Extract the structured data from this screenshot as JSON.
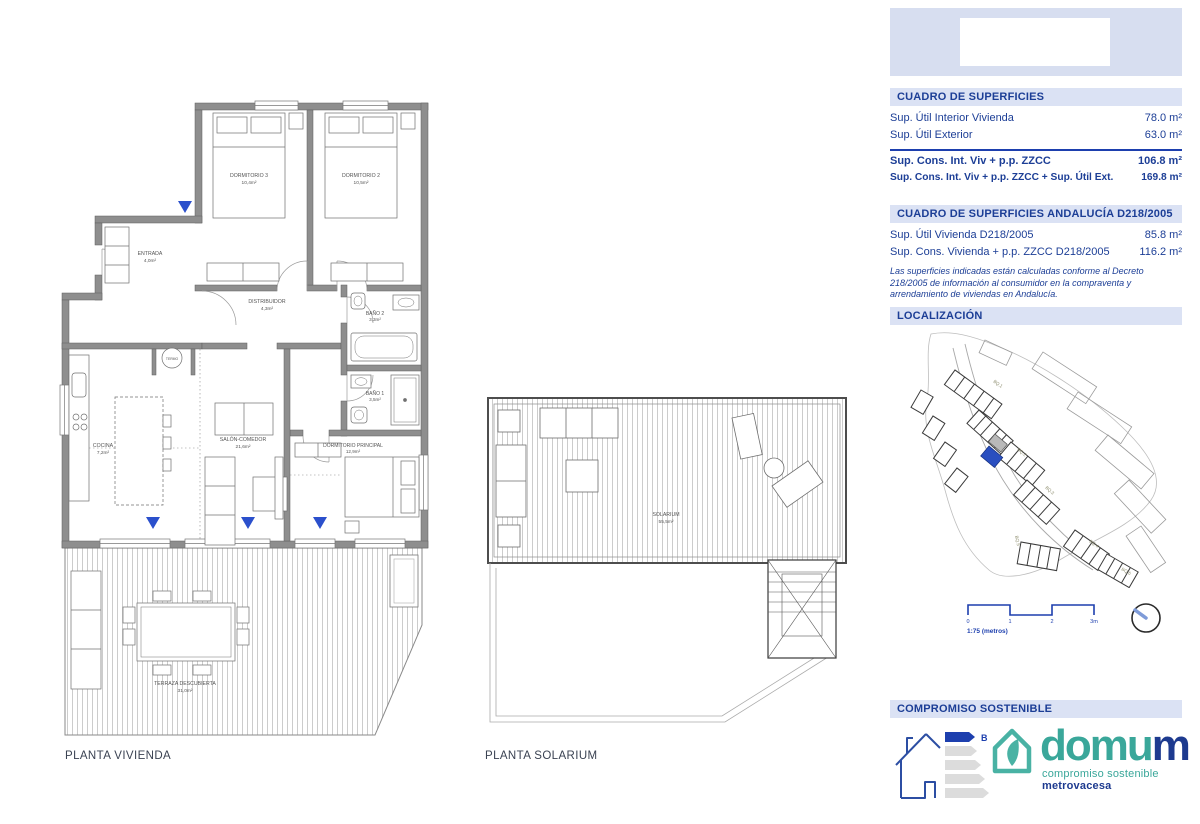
{
  "captions": {
    "vivienda": "PLANTA VIVIENDA",
    "solarium": "PLANTA SOLARIUM"
  },
  "rooms": {
    "dorm3": {
      "name": "DORMITORIO 3",
      "area": "10,4m²"
    },
    "dorm2": {
      "name": "DORMITORIO 2",
      "area": "10,5m²"
    },
    "entrada": {
      "name": "ENTRADA",
      "area": "4,0m²"
    },
    "distribuidor": {
      "name": "DISTRIBUIDOR",
      "area": "4,3m²"
    },
    "bano2": {
      "name": "BAÑO 2",
      "area": "3,3m²"
    },
    "bano1": {
      "name": "BAÑO 1",
      "area": "3,5m²"
    },
    "cocina": {
      "name": "COCINA",
      "area": "7,2m²"
    },
    "salon": {
      "name": "SALÓN-COMEDOR",
      "area": "21,6m²"
    },
    "dormppal": {
      "name": "DORMITORIO PRINCIPAL",
      "area": "12,9m²"
    },
    "terraza": {
      "name": "TERRAZA DESCUBIERTA",
      "area": "31,0m²"
    },
    "solarium": {
      "name": "SOLARIUM",
      "area": "55,5m²"
    },
    "termo": {
      "name": "TERMO"
    }
  },
  "panel": {
    "superficies": {
      "title": "CUADRO DE SUPERFICIES",
      "rows": [
        {
          "label": "Sup. Útil Interior Vivienda",
          "value": "78.0 m²"
        },
        {
          "label": "Sup. Útil Exterior",
          "value": "63.0 m²"
        }
      ],
      "totals": [
        {
          "label": "Sup. Cons. Int. Viv + p.p. ZZCC",
          "value": "106.8 m²"
        },
        {
          "label": "Sup. Cons. Int. Viv + p.p. ZZCC + Sup. Útil Ext.",
          "value": "169.8 m²"
        }
      ]
    },
    "andalucia": {
      "title": "CUADRO DE SUPERFICIES ANDALUCÍA D218/2005",
      "rows": [
        {
          "label": "Sup. Útil Vivienda D218/2005",
          "value": "85.8 m²"
        },
        {
          "label": "Sup. Cons. Vivienda + p.p. ZZCC D218/2005",
          "value": "116.2 m²"
        }
      ],
      "note": "Las superficies indicadas están calculadas conforme al Decreto 218/2005 de información al consumidor en la compraventa y arrendamiento de viviendas en Andalucía."
    },
    "localizacion": {
      "title": "LOCALIZACIÓN",
      "scale_ticks": [
        "0",
        "1",
        "2",
        "3m"
      ],
      "scale_label": "1:75 (metros)",
      "map_labels": [
        "BQ.1",
        "BQ.2",
        "BQ.3",
        "BQ.4",
        "BQ.5",
        "BQ.6"
      ]
    },
    "sostenible": {
      "title": "COMPROMISO SOSTENIBLE",
      "energy_rating": "B",
      "brand_part1": "domu",
      "brand_part2": "m",
      "tagline_part1": "compromiso sostenible ",
      "tagline_part2": "metrovacesa"
    }
  },
  "colors": {
    "accent_blue": "#1d3fae",
    "header_bg": "#dbe2f4",
    "wall_gray": "#8e8e8e",
    "teal": "#3aa79a",
    "highlight_unit": "#2a4fc0"
  }
}
